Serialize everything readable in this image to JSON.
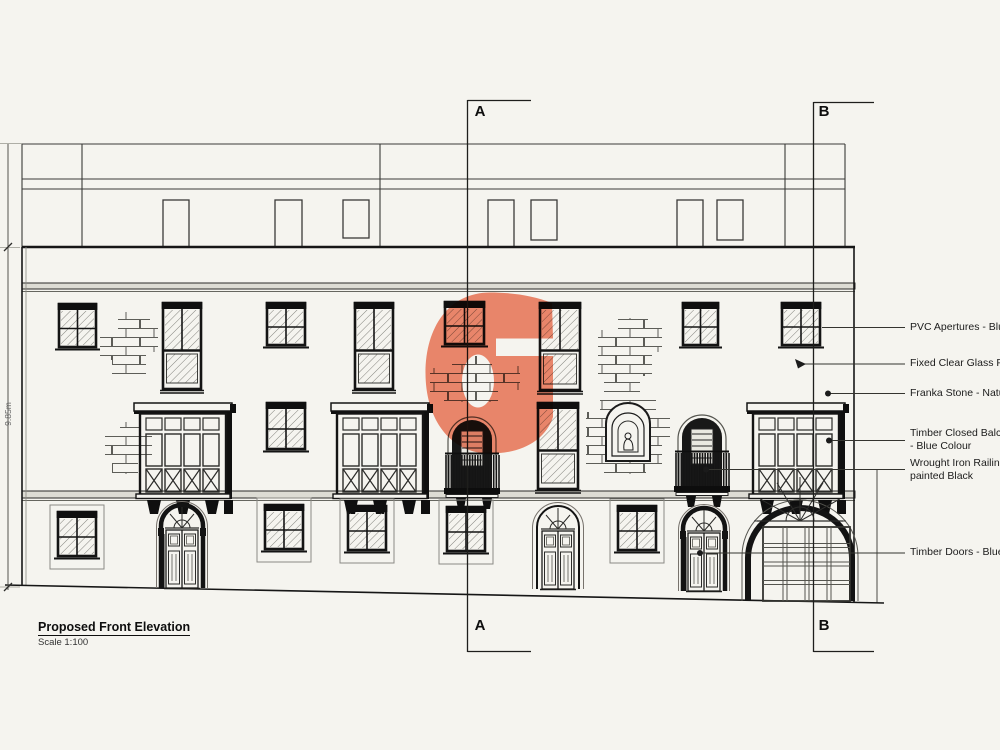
{
  "page": {
    "background": "#f5f4ef"
  },
  "titleblock": {
    "title": "Proposed Front Elevation",
    "scale": "Scale 1:100"
  },
  "sections": {
    "marker_a": "A",
    "marker_b": "B"
  },
  "dimensions": {
    "height_label": "9.85m"
  },
  "annotations": [
    {
      "line1": "PVC Apertures - Blue Colour",
      "line2": ""
    },
    {
      "line1": "Fixed Clear Glass Panels",
      "line2": ""
    },
    {
      "line1": "Franka Stone - Natural",
      "line2": ""
    },
    {
      "line1": "Timber Closed Balcony",
      "line2": "- Blue Colour"
    },
    {
      "line1": "Wrought Iron Railings",
      "line2": "painted Black"
    },
    {
      "line1": "Timber Doors - Blue Colour",
      "line2": ""
    }
  ],
  "watermark": {
    "letter": "G",
    "color": "#F28569"
  }
}
